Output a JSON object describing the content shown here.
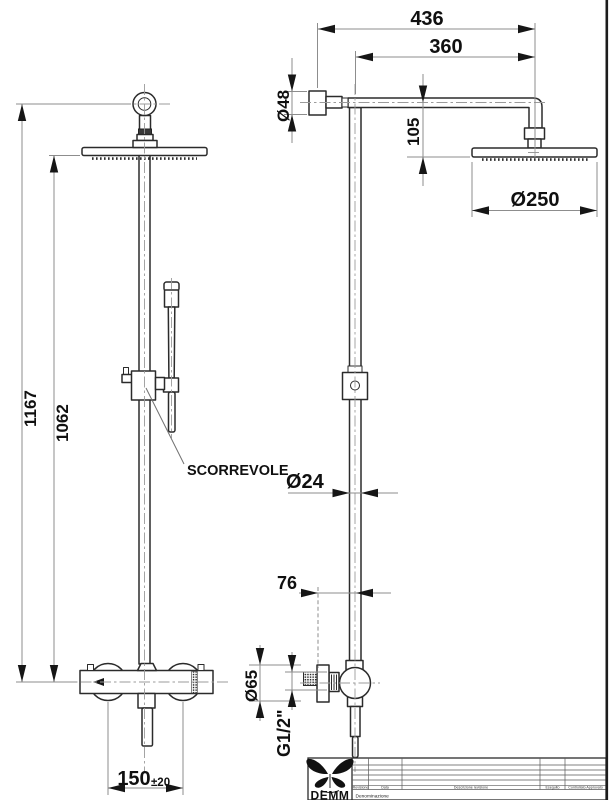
{
  "colors": {
    "ink": "#2b2b2b",
    "dimension_line": "#8d8d8d",
    "background": "#ffffff"
  },
  "front_view": {
    "height_total": "1167",
    "height_to_head": "1062",
    "inlet_distance": "150",
    "inlet_tolerance": "±20",
    "slider_label": "SCORREVOLE"
  },
  "side_view": {
    "arm_total": "436",
    "arm_length": "360",
    "wall_flange_dia": "Ø48",
    "head_drop": "105",
    "head_dia": "Ø250",
    "pipe_dia": "Ø24",
    "wall_offset": "76",
    "knob_dia": "Ø65",
    "thread": "G1/2\""
  },
  "title_block": {
    "brand": "DEMM",
    "denomination_label": "Denominazione",
    "columns": [
      "Revisione",
      "Data",
      "Descrizione revisione",
      "Eseguito",
      "Controllato Approvato"
    ]
  }
}
